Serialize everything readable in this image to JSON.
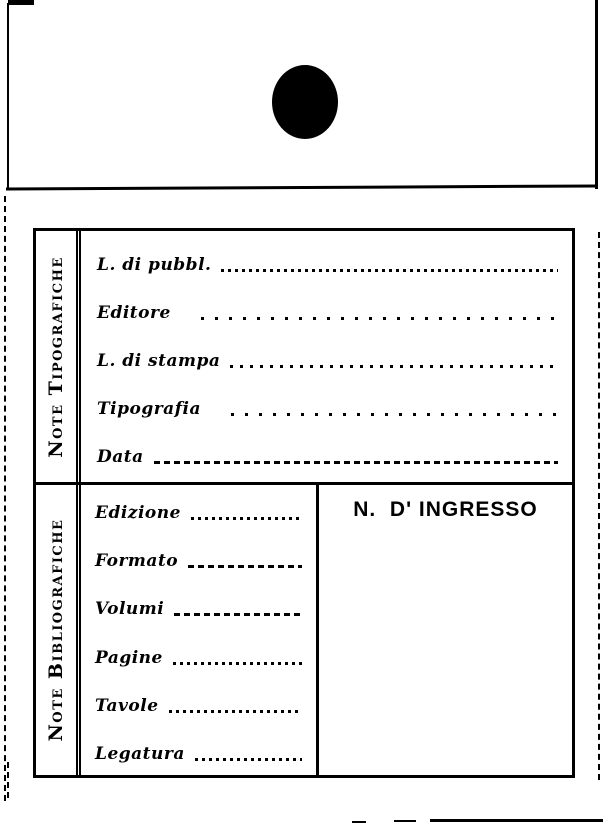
{
  "form": {
    "typographic_section": {
      "side_label": "Note Tipografiche",
      "fields": [
        {
          "label": "L. di pubbl.",
          "value": ""
        },
        {
          "label": "Editore",
          "value": ""
        },
        {
          "label": "L. di stampa",
          "value": ""
        },
        {
          "label": "Tipografia",
          "value": ""
        },
        {
          "label": "Data",
          "value": ""
        }
      ]
    },
    "bibliographic_section": {
      "side_label": "Note Bibliografiche",
      "fields": [
        {
          "label": "Edizione",
          "value": ""
        },
        {
          "label": "Formato",
          "value": ""
        },
        {
          "label": "Volumi",
          "value": ""
        },
        {
          "label": "Pagine",
          "value": ""
        },
        {
          "label": "Tavole",
          "value": ""
        },
        {
          "label": "Legatura",
          "value": ""
        }
      ]
    },
    "ingresso_box": {
      "title": "N.  D' INGRESSO"
    }
  },
  "colors": {
    "ink": "#000000",
    "paper": "#ffffff"
  }
}
